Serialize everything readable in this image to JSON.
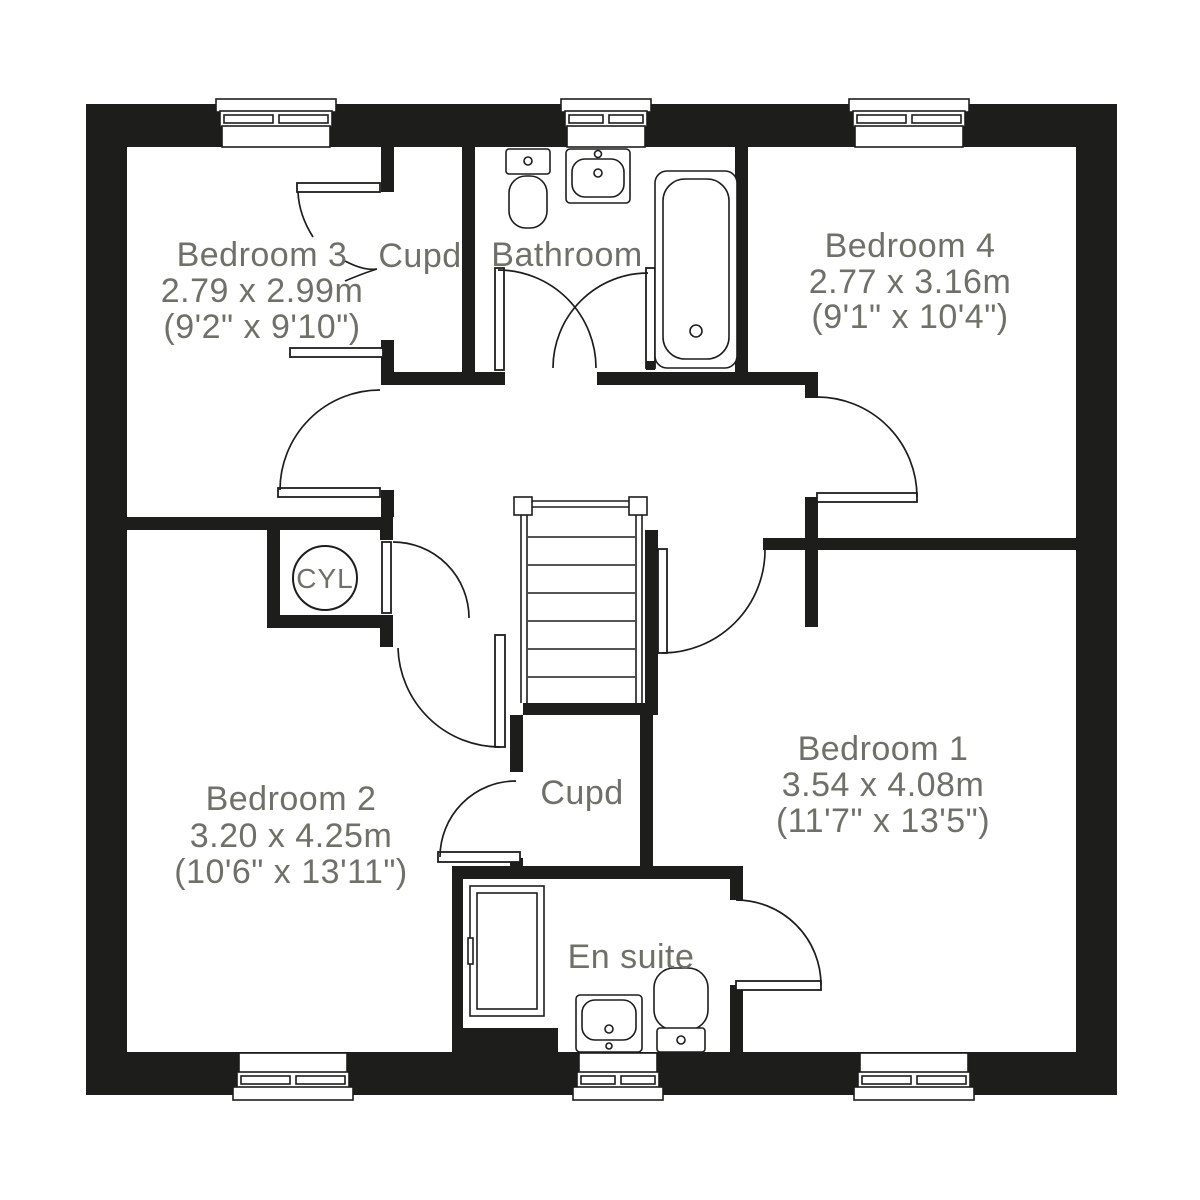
{
  "plan": {
    "title": "First floor plan",
    "rooms": [
      {
        "id": "bedroom3",
        "label": "Bedroom 3",
        "metric": "2.79 x 2.99m",
        "imperial": "(9'2\" x 9'10\")"
      },
      {
        "id": "cupd-top",
        "label": "Cupd"
      },
      {
        "id": "bathroom",
        "label": "Bathroom"
      },
      {
        "id": "bedroom4",
        "label": "Bedroom 4",
        "metric": "2.77 x 3.16m",
        "imperial": "(9'1\" x 10'4\")"
      },
      {
        "id": "cylinder",
        "label": "CYL"
      },
      {
        "id": "bedroom2",
        "label": "Bedroom 2",
        "metric": "3.20 x 4.25m",
        "imperial": "(10'6\" x 13'11\")"
      },
      {
        "id": "cupd-bottom",
        "label": "Cupd"
      },
      {
        "id": "ensuite",
        "label": "En suite"
      },
      {
        "id": "bedroom1",
        "label": "Bedroom 1",
        "metric": "3.54 x 4.08m",
        "imperial": "(11'7\" x 13'5\")"
      }
    ],
    "fixtures": {
      "bathroom": [
        "toilet",
        "wash-basin",
        "bath"
      ],
      "ensuite": [
        "shower",
        "wash-basin",
        "toilet"
      ],
      "cylinder": [
        "hot-water-cylinder"
      ]
    },
    "counts": {
      "windows": 6,
      "doors": 8,
      "stair_flights": 1
    },
    "colors": {
      "wall": "#1d1d1b",
      "text": "#6f7168",
      "background": "#ffffff"
    }
  }
}
